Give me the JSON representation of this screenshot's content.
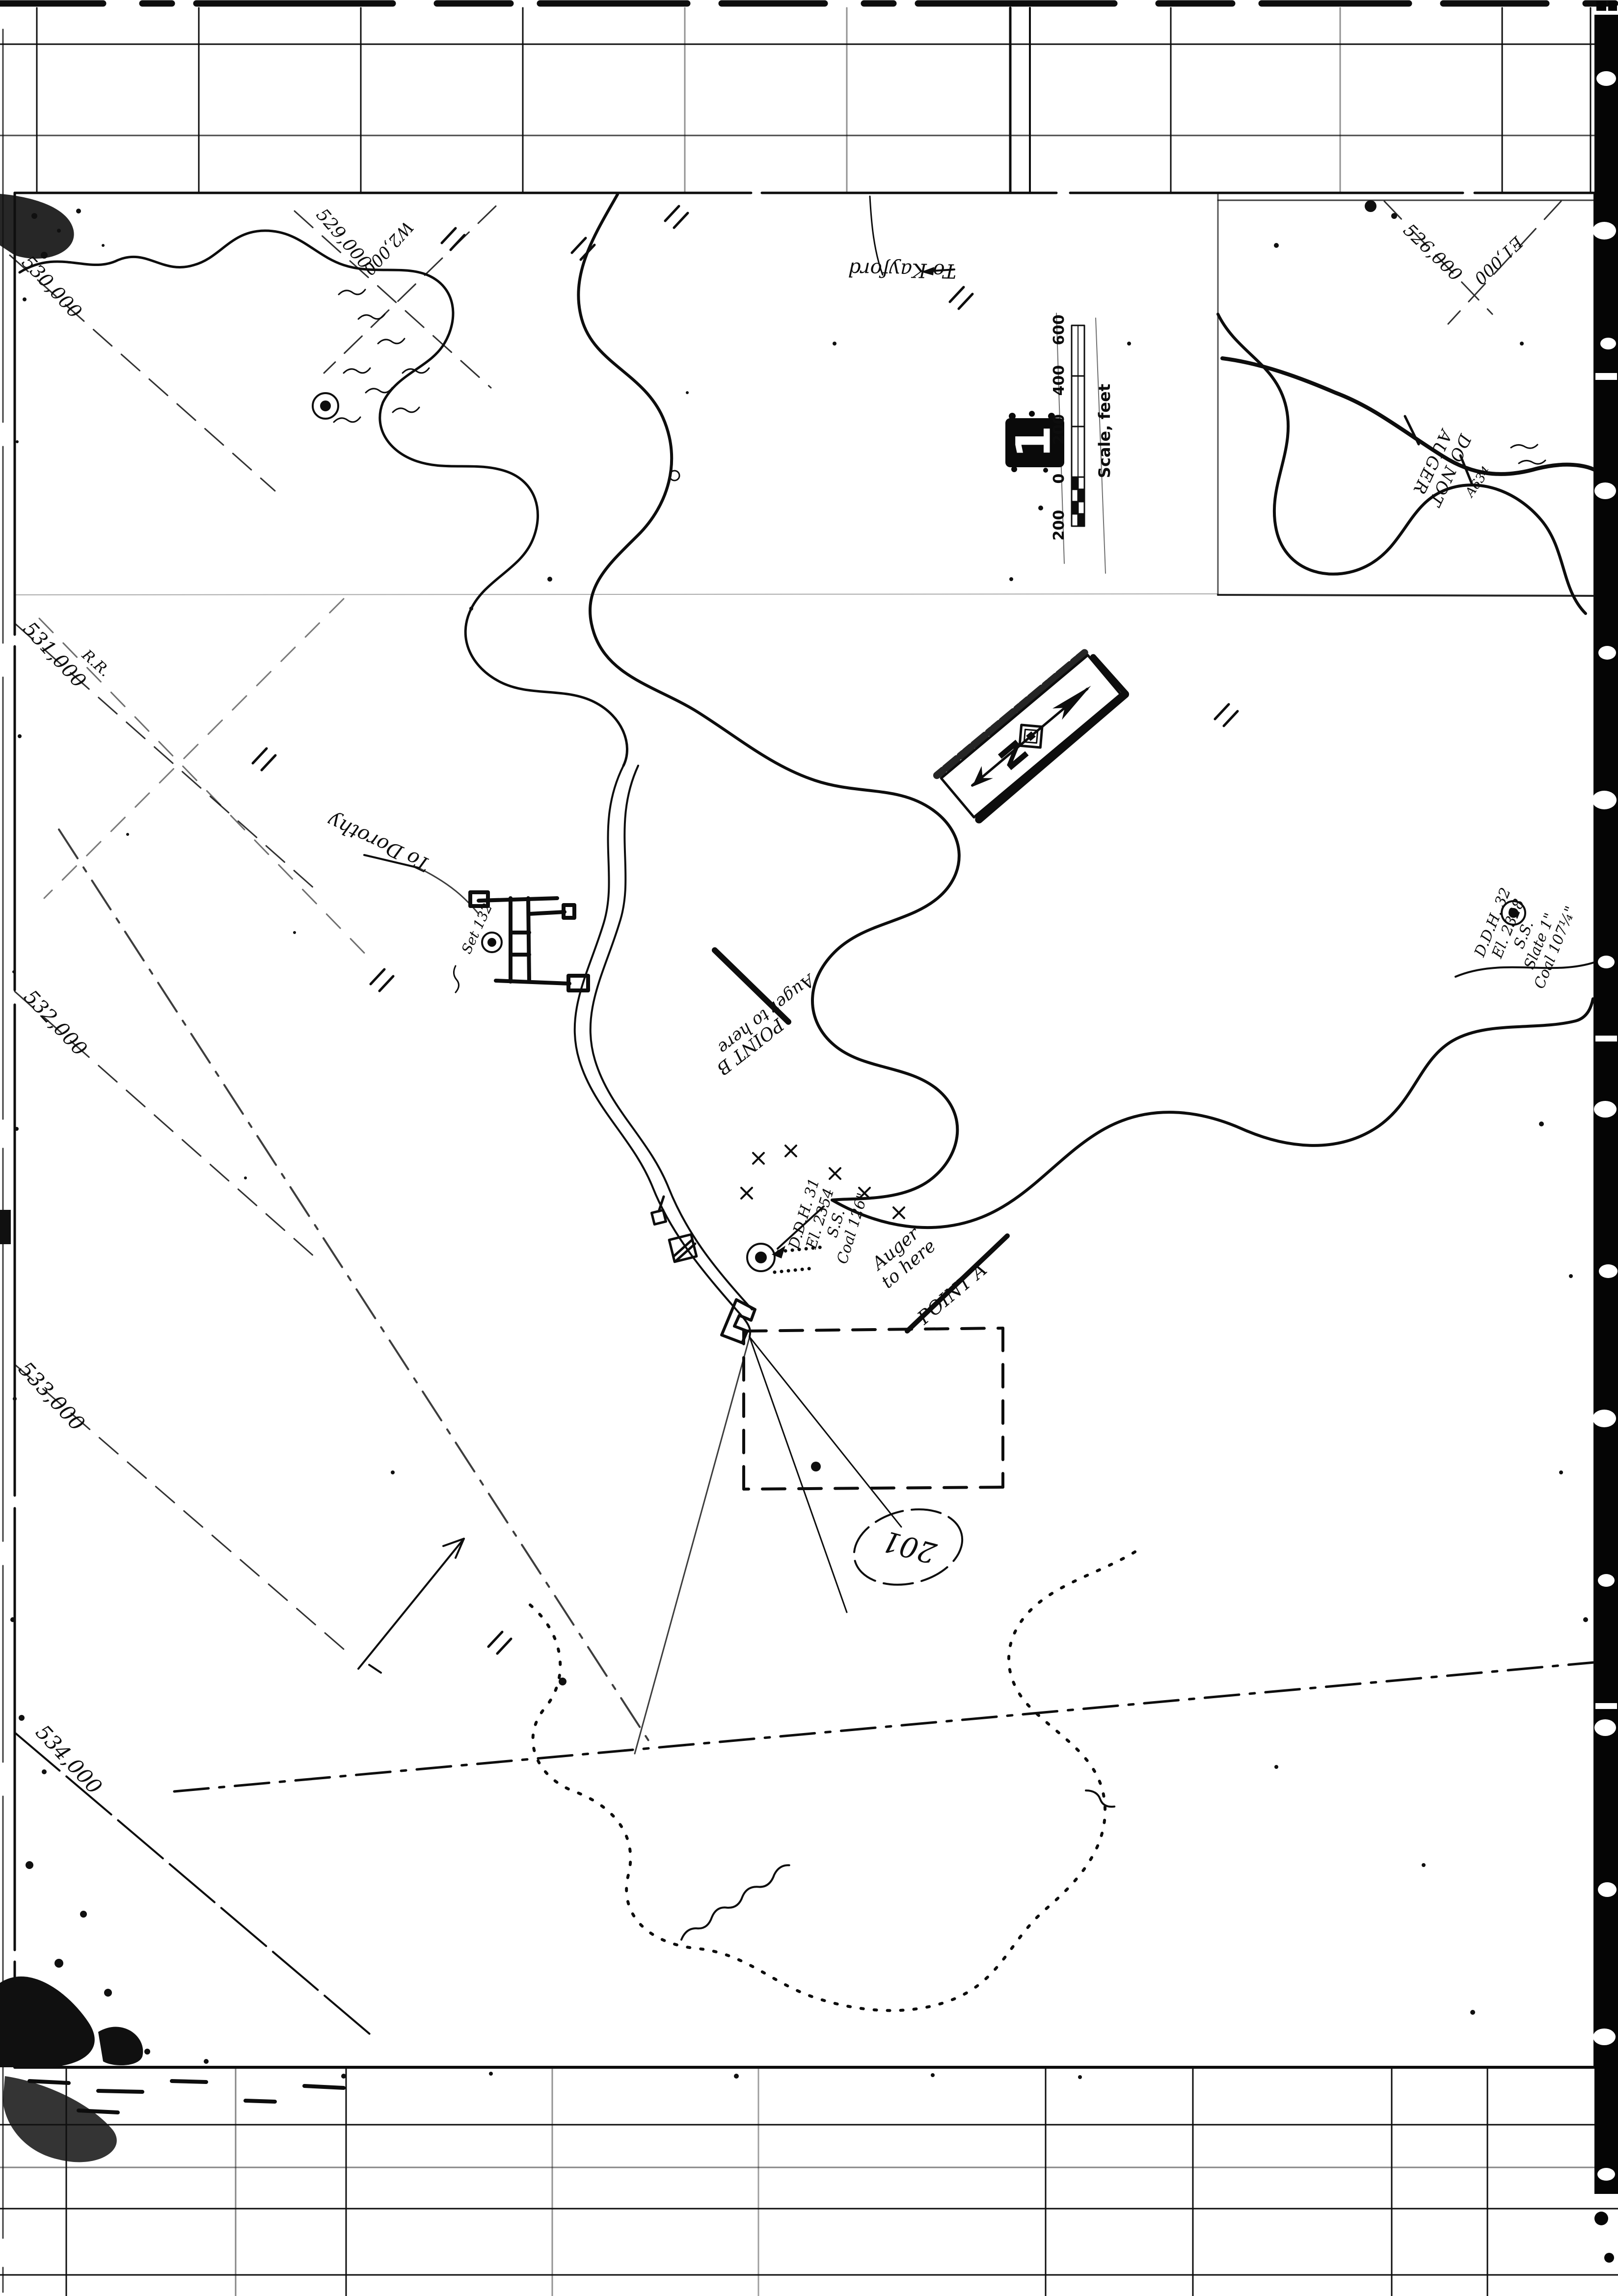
{
  "page": {
    "description": "Scanned black-and-white coal mining survey map, photostat film frame",
    "film_frame_number": "1"
  },
  "scale_bar": {
    "title": "Scale, feet",
    "ticks": [
      "200",
      "0",
      "200",
      "400",
      "600"
    ]
  },
  "north_arrow": {
    "label": "N"
  },
  "grid_labels": {
    "top_left": "530,000",
    "left_1": "531,000",
    "left_2": "532,000",
    "left_3": "533,000",
    "left_4": "534,000",
    "upper_529": "529,000",
    "upper_w2000": "W2,000",
    "top_right_526": "526,000",
    "top_right_e1000": "E1,000"
  },
  "route_labels": {
    "kayford": "To Kayford",
    "dorothy": "To Dorothy"
  },
  "drill_holes": {
    "ddh31": "D.D.H. 31\nEl. 2354\nS.S.\nCoal 126\"",
    "ddh32": "D.D.H. 32\nEl. 2328\nS.S.\nSlate 1\"\nCoal 107¼\""
  },
  "notes": {
    "auger_a_lead": "Auger\nto here",
    "auger_a_point": "POINT A",
    "auger_b_lead": "Auger to here",
    "auger_b_point": "POINT B",
    "do_not_auger": "DO NOT\nAUGER",
    "station_a634": "A634",
    "circled_201": "201",
    "railroad": "R.R.",
    "set_132": "Set 132"
  }
}
